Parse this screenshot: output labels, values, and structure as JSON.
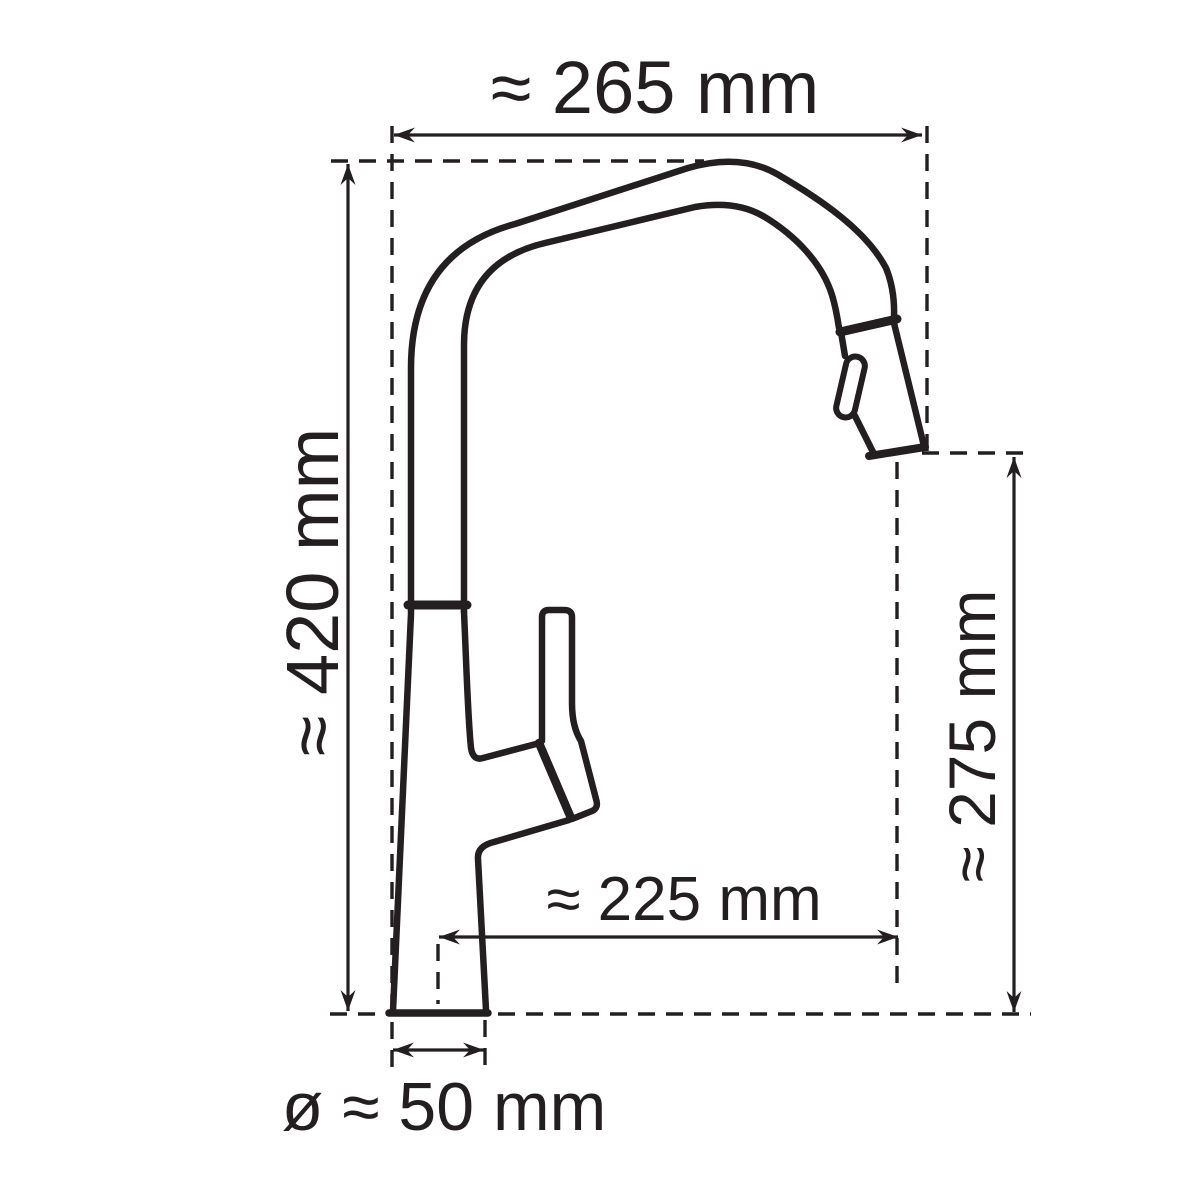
{
  "diagram": {
    "subject": "kitchen-faucet-side-view-dimension-drawing",
    "background_color": "#ffffff",
    "line_color": "#231f20",
    "dimensions": [
      {
        "id": "spout-width-top",
        "label": "≈ 265 mm",
        "value": 265,
        "unit": "mm",
        "approx": true,
        "orientation": "horizontal",
        "position": "top"
      },
      {
        "id": "total-height-left",
        "label": "≈ 420 mm",
        "value": 420,
        "unit": "mm",
        "approx": true,
        "orientation": "vertical",
        "position": "left"
      },
      {
        "id": "outlet-height-right",
        "label": "≈ 275 mm",
        "value": 275,
        "unit": "mm",
        "approx": true,
        "orientation": "vertical",
        "position": "right"
      },
      {
        "id": "spout-reach-inner",
        "label": "≈ 225 mm",
        "value": 225,
        "unit": "mm",
        "approx": true,
        "orientation": "horizontal",
        "position": "middle"
      },
      {
        "id": "base-diameter",
        "label": "ø ≈ 50 mm",
        "value": 50,
        "unit": "mm",
        "approx": true,
        "orientation": "horizontal",
        "position": "bottom",
        "diameter": true
      }
    ]
  }
}
